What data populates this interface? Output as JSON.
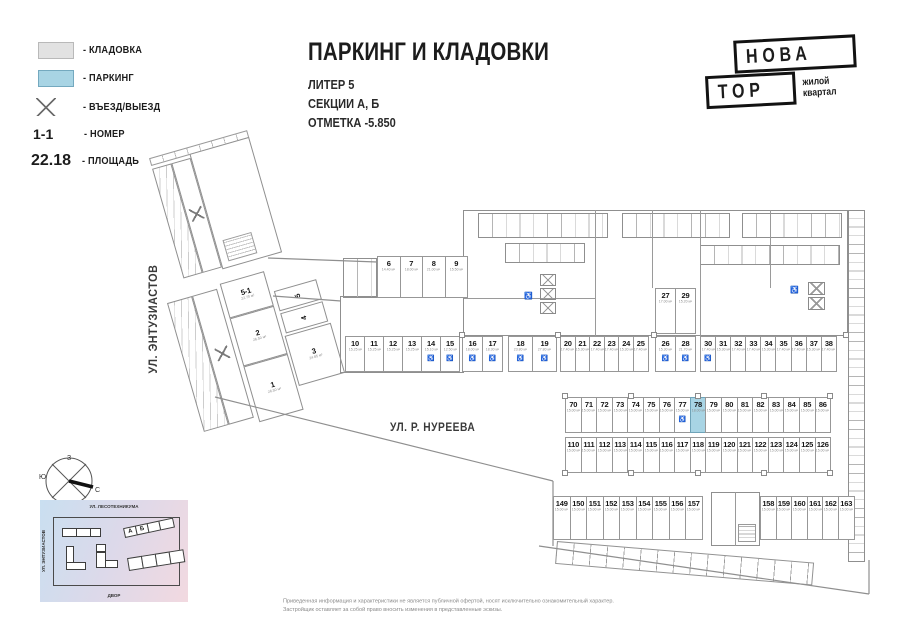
{
  "header": {
    "title": "ПАРКИНГ И КЛАДОВКИ",
    "subtitle1": "ЛИТЕР 5",
    "subtitle2": "СЕКЦИИ А, Б",
    "subtitle3": "ОТМЕТКА -5.850"
  },
  "legend": {
    "storage_label": "- КЛАДОВКА",
    "parking_label": "- ПАРКИНГ",
    "entrance_label": "- ВЪЕЗД/ВЫЕЗД",
    "number_symbol": "1-1",
    "number_label": "- НОМЕР",
    "area_symbol": "22.18",
    "area_label": "- ПЛОЩАДЬ"
  },
  "logo": {
    "line1": "НОВА",
    "line2": "ТОР",
    "tag1": "жилой",
    "tag2": "квартал"
  },
  "streets": {
    "left_street": "УЛ. ЭНТУЗИАСТОВ",
    "bottom_street": "УЛ. Р. НУРЕЕВА"
  },
  "colors": {
    "parking_fill": "#a8d4e4",
    "storage_fill": "#e2e2e2"
  },
  "compass": {
    "top": "З",
    "left": "Ю",
    "right": "С",
    "bottom": "В"
  },
  "site_plan": {
    "street_top": "УЛ. ЛЕСОТЕХНИКУМА",
    "street_left": "УЛ. ЭНТУЗИАСТОВ",
    "yard": "ДВОР",
    "building_a": "А",
    "building_b": "Б"
  },
  "disclaimer": {
    "line1": "Приведенная информация и характеристики не является публичной офертой, носят исключительно ознакомительный характер.",
    "line2": "Застройщик оставляет за собой право вносить изменения в представленные эскизы."
  },
  "plan": {
    "left_units": {
      "u51": {
        "n": "5-1",
        "a": "22.70 м²"
      },
      "u2": {
        "n": "2",
        "a": "26.50 м²"
      },
      "u1": {
        "n": "1",
        "a": "26.50 м²"
      },
      "u3": {
        "n": "3",
        "a": "24.85 м²"
      },
      "u4": {
        "n": "4",
        "a": "15.50 м²"
      },
      "u5": {
        "n": "5",
        "a": "13.50 м²"
      }
    },
    "rows": {
      "r6_9": [
        {
          "n": "6",
          "a": "14.40 м²"
        },
        {
          "n": "7",
          "a": "18.00 м²"
        },
        {
          "n": "8",
          "a": "21.00 м²"
        },
        {
          "n": "9",
          "a": "15.50 м²"
        }
      ],
      "r10_15": [
        {
          "n": "10",
          "a": "15.25 м²"
        },
        {
          "n": "11",
          "a": "15.25 м²"
        },
        {
          "n": "12",
          "a": "15.25 м²"
        },
        {
          "n": "13",
          "a": "15.25 м²"
        },
        {
          "n": "14",
          "a": "15.10 м²",
          "acc": true
        },
        {
          "n": "15",
          "a": "12.50 м²",
          "acc": true
        }
      ],
      "r16_17": [
        {
          "n": "16",
          "a": "18.00 м²",
          "acc": true
        },
        {
          "n": "17",
          "a": "18.30 м²",
          "acc": true
        }
      ],
      "r18_19": [
        {
          "n": "18",
          "a": "23.80 м²",
          "acc": true
        },
        {
          "n": "19",
          "a": "27.80 м²",
          "acc": true
        }
      ],
      "r20_25": [
        {
          "n": "20",
          "a": "17.40 м²"
        },
        {
          "n": "21",
          "a": "15.30 м²"
        },
        {
          "n": "22",
          "a": "17.40 м²"
        },
        {
          "n": "23",
          "a": "17.40 м²"
        },
        {
          "n": "24",
          "a": "15.30 м²"
        },
        {
          "n": "25",
          "a": "17.40 м²"
        }
      ],
      "r26_28": [
        {
          "n": "26",
          "a": "15.30 м²",
          "acc": true
        },
        {
          "n": "28",
          "a": "21.70 м²",
          "acc": true
        }
      ],
      "r27_29": [
        {
          "n": "27",
          "a": "17.00 м²"
        },
        {
          "n": "29",
          "a": "15.20 м²"
        }
      ],
      "r30_38": [
        {
          "n": "30",
          "a": "17.40 м²",
          "acc": true
        },
        {
          "n": "31",
          "a": "15.30 м²"
        },
        {
          "n": "32",
          "a": "17.40 м²"
        },
        {
          "n": "33",
          "a": "17.40 м²"
        },
        {
          "n": "34",
          "a": "15.30 м²"
        },
        {
          "n": "35",
          "a": "17.40 м²"
        },
        {
          "n": "36",
          "a": "17.40 м²"
        },
        {
          "n": "37",
          "a": "15.30 м²"
        },
        {
          "n": "38",
          "a": "17.40 м²"
        }
      ],
      "r70_86": [
        {
          "n": "70",
          "a": "15.00 м²"
        },
        {
          "n": "71",
          "a": "15.00 м²"
        },
        {
          "n": "72",
          "a": "15.00 м²"
        },
        {
          "n": "73",
          "a": "15.00 м²"
        },
        {
          "n": "74",
          "a": "15.00 м²"
        },
        {
          "n": "75",
          "a": "15.00 м²"
        },
        {
          "n": "76",
          "a": "15.00 м²"
        },
        {
          "n": "77",
          "a": "15.00 м²",
          "acc": true
        },
        {
          "n": "78",
          "a": "18.00 м²",
          "hl": true
        },
        {
          "n": "79",
          "a": "15.00 м²"
        },
        {
          "n": "80",
          "a": "15.00 м²"
        },
        {
          "n": "81",
          "a": "15.00 м²"
        },
        {
          "n": "82",
          "a": "15.00 м²"
        },
        {
          "n": "83",
          "a": "15.00 м²"
        },
        {
          "n": "84",
          "a": "15.00 м²"
        },
        {
          "n": "85",
          "a": "15.00 м²"
        },
        {
          "n": "86",
          "a": "15.00 м²"
        }
      ],
      "r110_126": [
        {
          "n": "110",
          "a": "15.00 м²"
        },
        {
          "n": "111",
          "a": "15.00 м²"
        },
        {
          "n": "112",
          "a": "15.00 м²"
        },
        {
          "n": "113",
          "a": "15.00 м²"
        },
        {
          "n": "114",
          "a": "15.00 м²"
        },
        {
          "n": "115",
          "a": "15.00 м²"
        },
        {
          "n": "116",
          "a": "15.00 м²"
        },
        {
          "n": "117",
          "a": "15.00 м²"
        },
        {
          "n": "118",
          "a": "15.00 м²"
        },
        {
          "n": "119",
          "a": "15.00 м²"
        },
        {
          "n": "120",
          "a": "15.00 м²"
        },
        {
          "n": "121",
          "a": "15.00 м²"
        },
        {
          "n": "122",
          "a": "15.00 м²"
        },
        {
          "n": "123",
          "a": "15.00 м²"
        },
        {
          "n": "124",
          "a": "15.00 м²"
        },
        {
          "n": "125",
          "a": "15.00 м²"
        },
        {
          "n": "126",
          "a": "15.00 м²"
        }
      ],
      "r149_157": [
        {
          "n": "149",
          "a": "15.00 м²"
        },
        {
          "n": "150",
          "a": "15.00 м²"
        },
        {
          "n": "151",
          "a": "15.00 м²"
        },
        {
          "n": "152",
          "a": "15.00 м²"
        },
        {
          "n": "153",
          "a": "15.00 м²"
        },
        {
          "n": "154",
          "a": "15.00 м²"
        },
        {
          "n": "155",
          "a": "15.00 м²"
        },
        {
          "n": "156",
          "a": "15.00 м²"
        },
        {
          "n": "157",
          "a": "15.00 м²"
        }
      ],
      "r158_163": [
        {
          "n": "158",
          "a": "15.00 м²"
        },
        {
          "n": "159",
          "a": "15.00 м²"
        },
        {
          "n": "160",
          "a": "15.00 м²"
        },
        {
          "n": "161",
          "a": "15.00 м²"
        },
        {
          "n": "162",
          "a": "15.00 м²"
        },
        {
          "n": "163",
          "a": "15.00 м²"
        }
      ]
    }
  }
}
